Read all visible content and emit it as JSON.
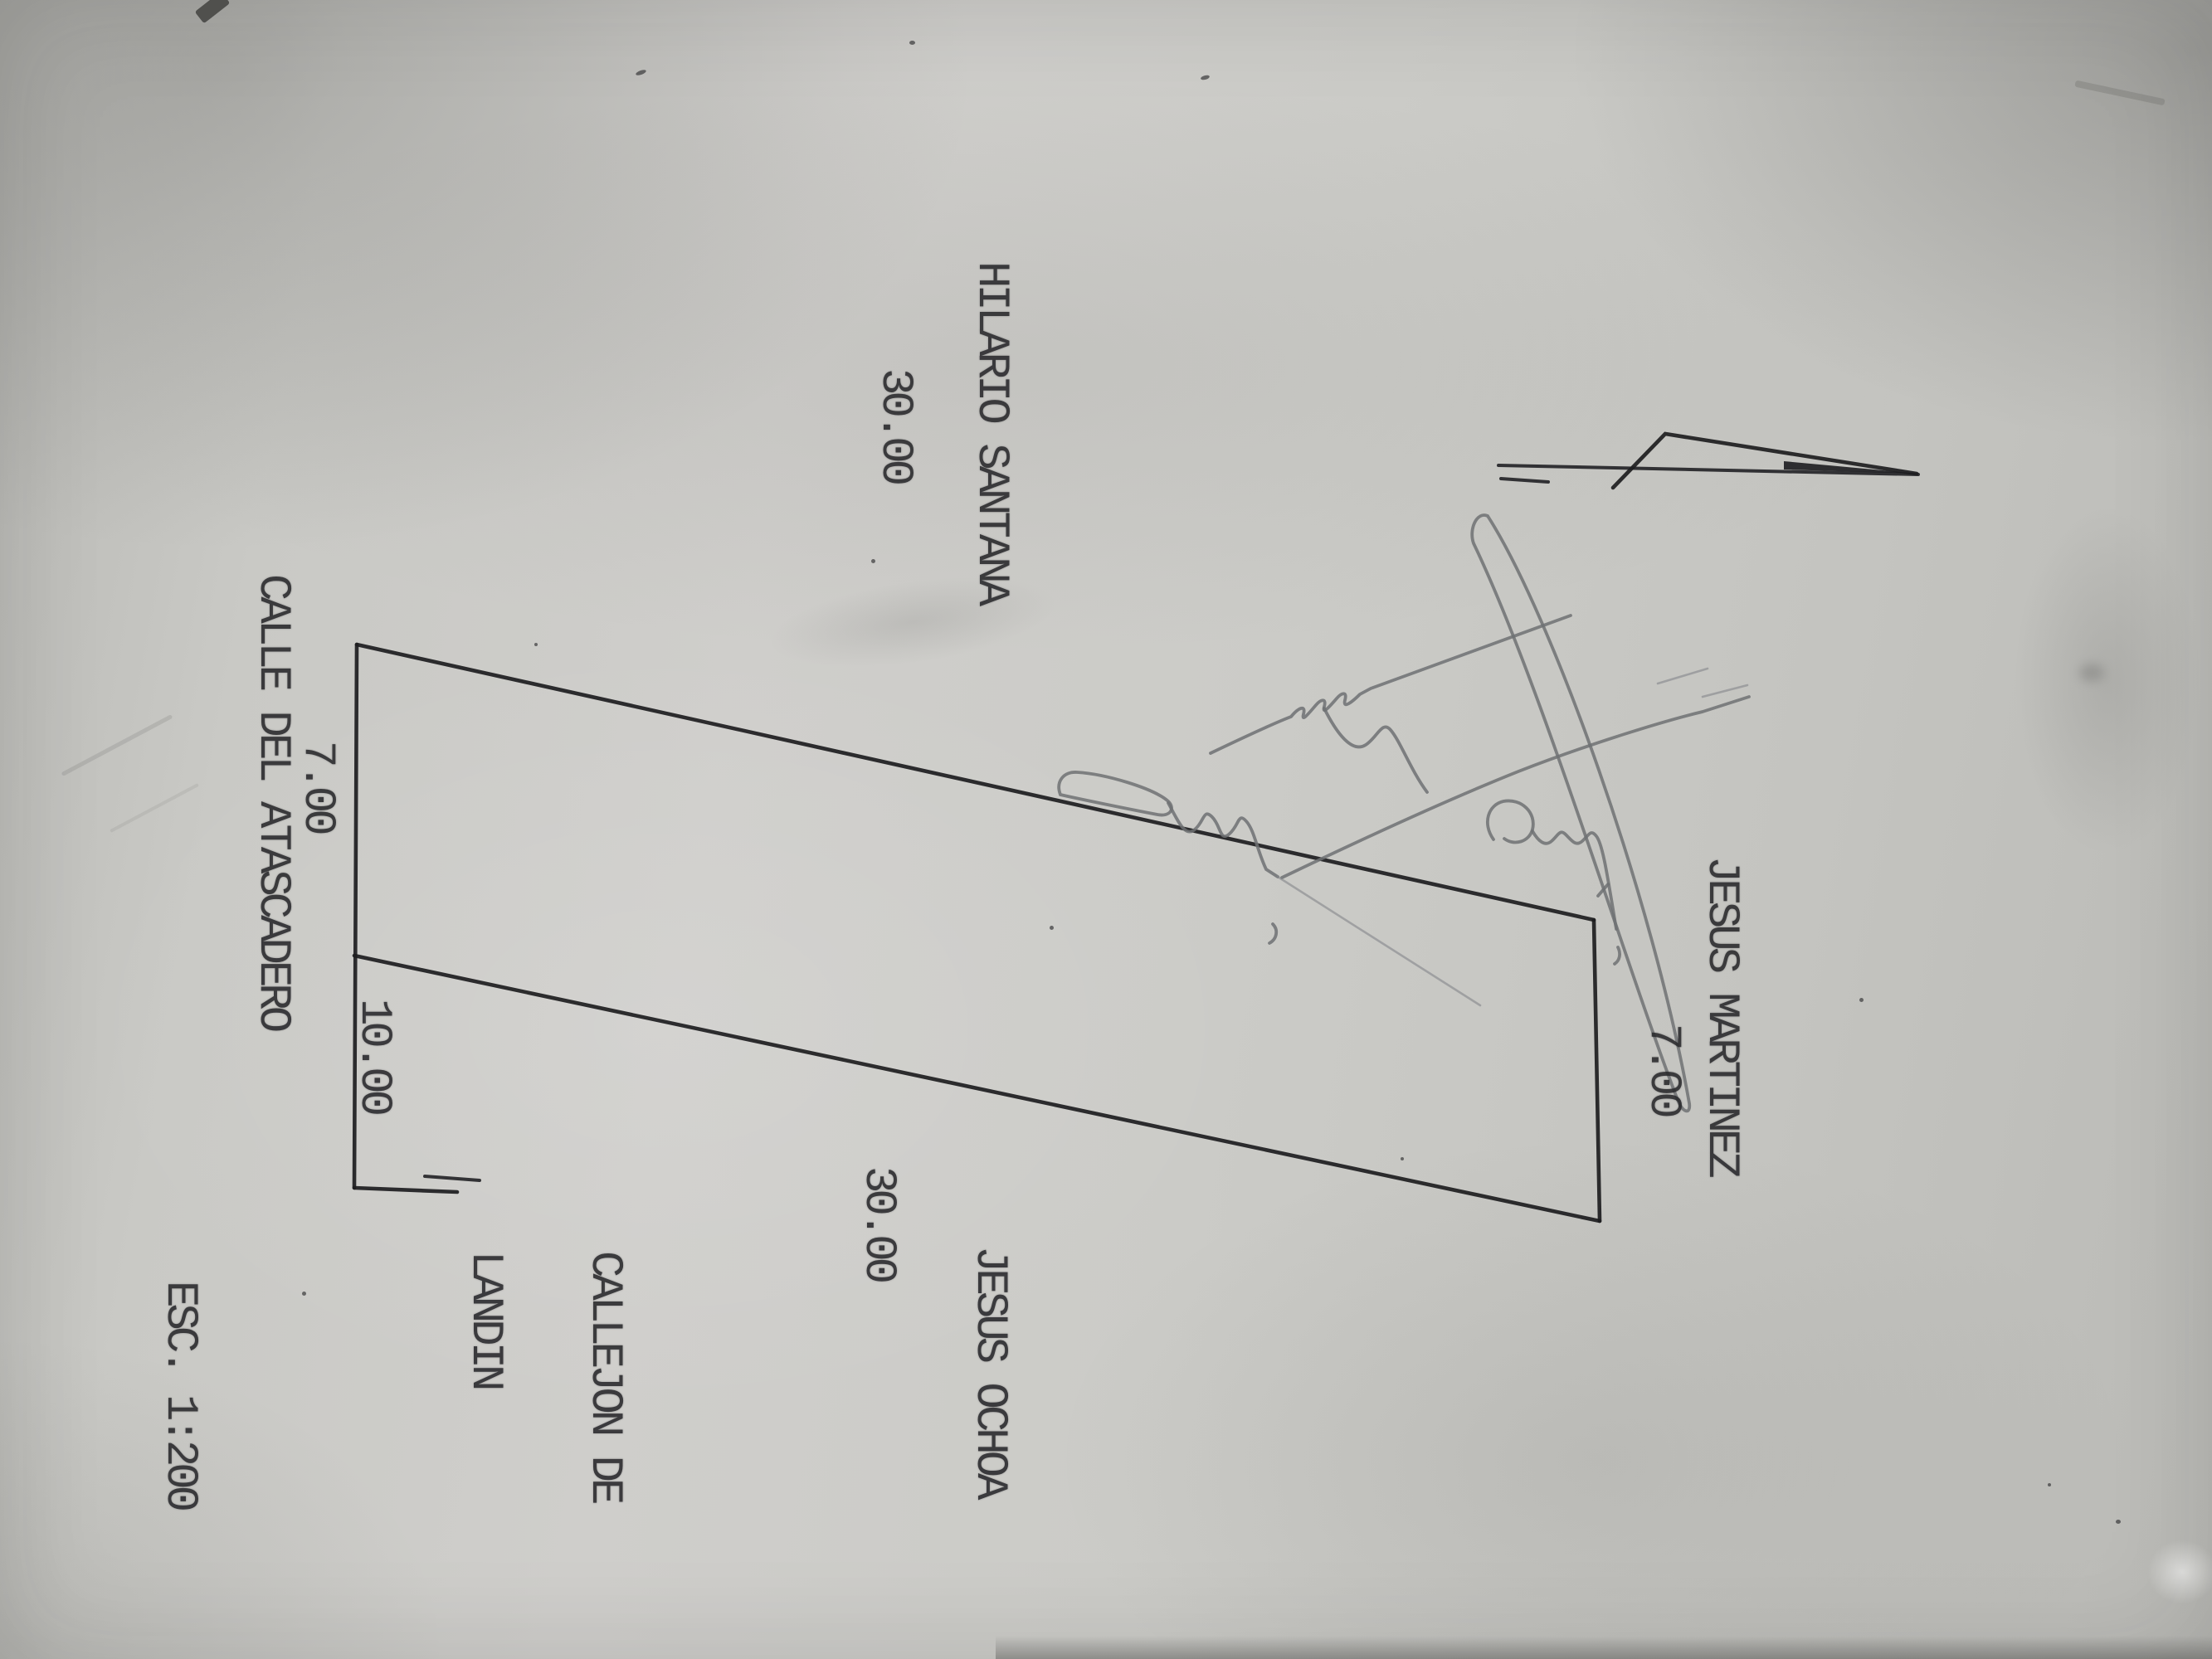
{
  "document": {
    "kind": "scanned land-parcel survey sketch",
    "scale_label": "ESC. 1:200",
    "handwriting_note": "illegible pencil signature"
  },
  "labels": {
    "neighbor_upper": "HILARIO SANTANA",
    "dim_upper": "30.00",
    "neighbor_right": "JESUS MARTINEZ",
    "dim_right": "7.00",
    "street_left": "CALLE DEL ATASCADERO",
    "dim_street_frontage": "7.00",
    "dim_alley_frontage": "10.00",
    "alley_line1": "CALLEJON DE",
    "alley_line2": "LANDIN",
    "dim_lower": "30.00",
    "neighbor_lower": "JESUS OCHOA",
    "scale": "ESC. 1:200"
  },
  "icons": {
    "north_arrow": "north-arrow"
  },
  "colors": {
    "paper": "#c9c9c5",
    "ink": "#1d1d20",
    "pencil": "#6e7173"
  }
}
